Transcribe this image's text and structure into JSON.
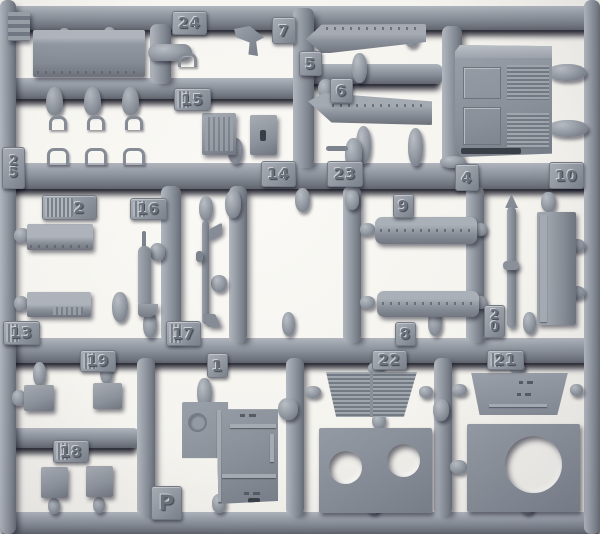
{
  "colors": {
    "plastic": "#8f95a0",
    "plastic_highlight": "#c3c7ce",
    "plastic_shadow": "#6b7078",
    "cast_shadow": "#0e0e18",
    "paper_background": "#f4f3ee"
  },
  "sprue": {
    "letter": "P",
    "tags": [
      {
        "label": "24"
      },
      {
        "label": "7"
      },
      {
        "label": "5"
      },
      {
        "label": "15"
      },
      {
        "label": "6"
      },
      {
        "label": "25"
      },
      {
        "label": "2"
      },
      {
        "label": "16"
      },
      {
        "label": "14"
      },
      {
        "label": "23"
      },
      {
        "label": "4"
      },
      {
        "label": "10"
      },
      {
        "label": "9"
      },
      {
        "label": "13"
      },
      {
        "label": "17"
      },
      {
        "label": "8"
      },
      {
        "label": "20"
      },
      {
        "label": "19"
      },
      {
        "label": "1"
      },
      {
        "label": "22"
      },
      {
        "label": "21"
      },
      {
        "label": "18"
      }
    ]
  }
}
